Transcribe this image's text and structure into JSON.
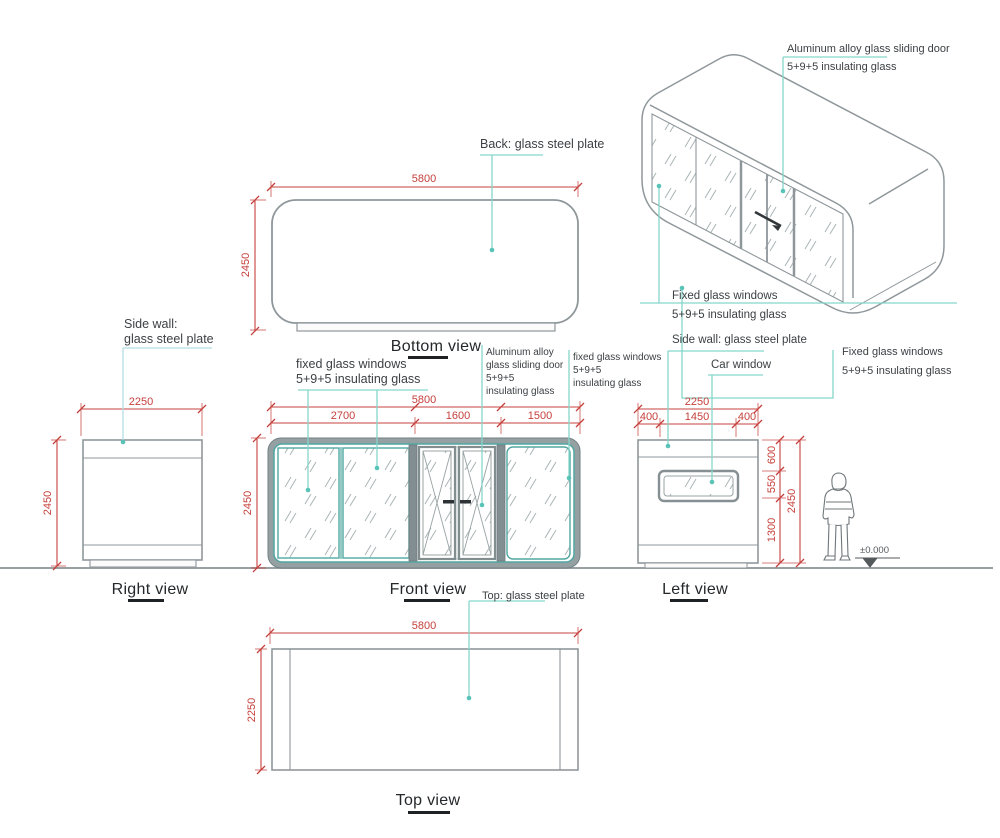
{
  "colors": {
    "dimension": "#c5403c",
    "leader": "#85d6c9",
    "leader_blue": "#b5dfe6",
    "line": "#8f979b",
    "accent": "#50a7a1"
  },
  "iso_view": {
    "door_note": [
      "Aluminum alloy glass sliding door",
      "5+9+5 insulating glass"
    ],
    "left_window_note": [
      "Fixed glass windows",
      "5+9+5 insulating glass"
    ],
    "right_window_note": [
      "Fixed glass windows",
      "5+9+5 insulating glass"
    ]
  },
  "bottom_view": {
    "label": "Bottom view",
    "back_note": "Back: glass steel plate",
    "width": "5800",
    "depth": "2450"
  },
  "right_view": {
    "label": "Right view",
    "side_wall_note": [
      "Side wall:",
      "glass steel plate"
    ],
    "width": "2250",
    "height": "2450"
  },
  "front_view": {
    "label": "Front view",
    "width": "5800",
    "height": "2450",
    "segments": [
      "2700",
      "1600",
      "1500"
    ],
    "left_window_note": [
      "fixed glass windows",
      "5+9+5 insulating glass"
    ],
    "door_note": [
      "Aluminum alloy",
      "glass sliding door",
      "5+9+5",
      "insulating glass"
    ],
    "right_window_note": [
      "fixed glass windows",
      "5+9+5",
      "insulating glass"
    ]
  },
  "left_view": {
    "label": "Left view",
    "side_wall_note": "Side wall: glass steel plate",
    "car_window_note": "Car window",
    "width": "2250",
    "segments": [
      "400",
      "1450",
      "400"
    ],
    "heights": [
      "600",
      "550",
      "1300"
    ],
    "height": "2450",
    "level_mark": "±0.000"
  },
  "top_view": {
    "label": "Top view",
    "top_note": "Top: glass steel plate",
    "width": "5800",
    "depth": "2250"
  }
}
